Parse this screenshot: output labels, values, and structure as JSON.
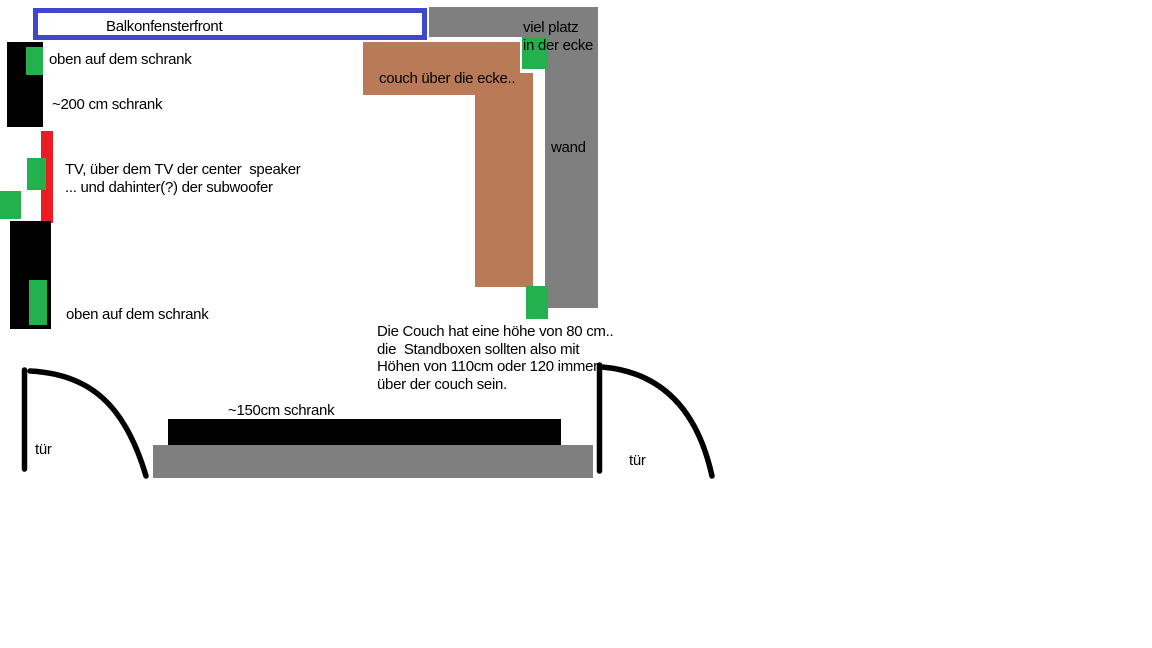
{
  "colors": {
    "blue": "#3F48CC",
    "green": "#22B14C",
    "red": "#ED1C24",
    "brown": "#B97A57",
    "gray": "#7F7F7F",
    "black": "#000000"
  },
  "window": {
    "label": "Balkonfensterfront"
  },
  "left_column": {
    "top_cabinet_speaker_label": "oben auf dem schrank",
    "cabinet_label": "~200 cm schrank",
    "tv_note_line1": "TV, über dem TV der center  speaker",
    "tv_note_line2": "... und dahinter(?) der subwoofer",
    "bottom_cabinet_speaker_label": "oben auf dem schrank"
  },
  "corner": {
    "line1": "viel platz",
    "line2": "in der ecke"
  },
  "couch": {
    "label": "couch über die ecke.."
  },
  "wall": {
    "label": "wand"
  },
  "couch_note": {
    "line1": "Die Couch hat eine höhe von 80 cm..",
    "line2": "die  Standboxen sollten also mit",
    "line3": "Höhen von 110cm oder 120 immer",
    "line4": "über der couch sein."
  },
  "bottom": {
    "cabinet_label": "~150cm schrank",
    "door_left_label": "tür",
    "door_right_label": "tür"
  }
}
